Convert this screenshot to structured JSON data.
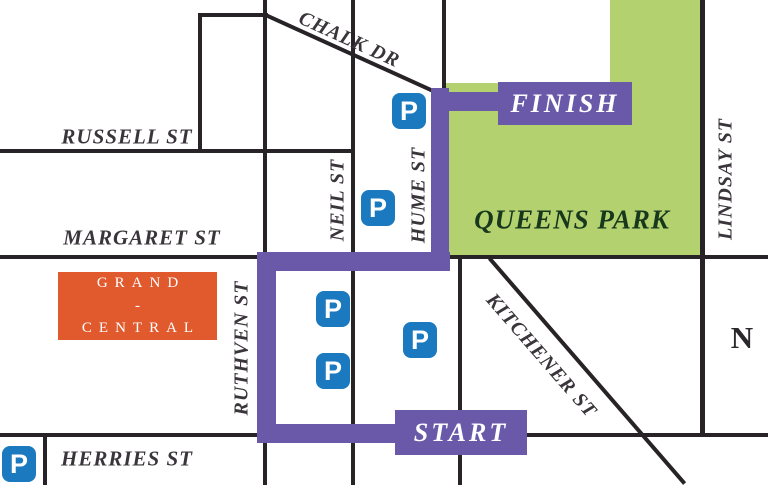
{
  "colors": {
    "background": "#ffffff",
    "street_line": "#272326",
    "street_label_text": "#3a353b",
    "route_purple": "#6a59a8",
    "park_green": "#b4d170",
    "park_label_green": "#17381c",
    "grand_central_orange": "#e05a2e",
    "parking_blue": "#1b79c0",
    "badge_text_white": "#ffffff"
  },
  "streets": {
    "chalk_dr": "CHALK DR",
    "russell_st": "RUSSELL ST",
    "margaret_st": "MARGARET ST",
    "herries_st": "HERRIES ST",
    "neil_st": "NEIL ST",
    "hume_st": "HUME ST",
    "ruthven_st": "RUTHVEN ST",
    "lindsay_st": "LINDSAY ST",
    "kitchener_st": "KITCHENER ST"
  },
  "places": {
    "queens_park": "QUEENS PARK",
    "grand_central_line1": "GRAND",
    "grand_central_line2": "-",
    "grand_central_line3": "CENTRAL"
  },
  "route": {
    "start_label": "START",
    "finish_label": "FINISH"
  },
  "compass": {
    "north_label": "N"
  },
  "parking": {
    "symbol": "P"
  }
}
